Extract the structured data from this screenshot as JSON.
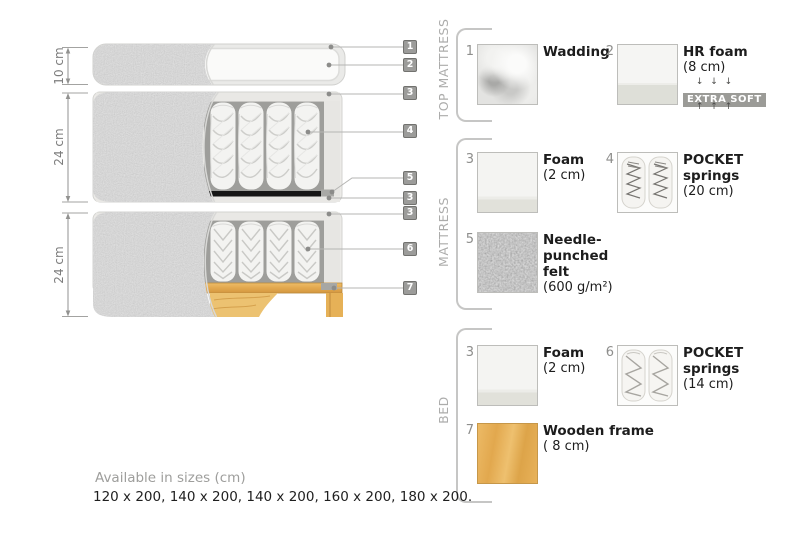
{
  "diagram": {
    "dim_labels": [
      "10 cm",
      "24 cm",
      "24 cm"
    ],
    "callouts": [
      "1",
      "2",
      "3",
      "4",
      "5",
      "3",
      "3",
      "6",
      "7"
    ]
  },
  "legend": {
    "groups": [
      {
        "title": "TOP MATTRESS"
      },
      {
        "title": "MATTRESS"
      },
      {
        "title": "BED"
      }
    ],
    "items": {
      "wadding": {
        "num": "1",
        "name": "Wadding"
      },
      "hr_foam": {
        "num": "2",
        "name": "HR foam",
        "detail": "(8 cm)",
        "arrows_down": "↓ ↓ ↓",
        "badge": "EXTRA SOFT",
        "arrows_up": "↑ ↑ ↑"
      },
      "foam_mattress": {
        "num": "3",
        "name": "Foam",
        "detail": "(2 cm)"
      },
      "pocket_20": {
        "num": "4",
        "line1": "POCKET",
        "line2": "springs",
        "detail": "(20 cm)"
      },
      "felt": {
        "num": "5",
        "line1": "Needle-",
        "line2": "punched",
        "line3": "felt",
        "detail": "(600 g/m²)"
      },
      "foam_bed": {
        "num": "3",
        "name": "Foam",
        "detail": "(2 cm)"
      },
      "pocket_14": {
        "num": "6",
        "line1": "POCKET",
        "line2": "springs",
        "detail": "(14 cm)"
      },
      "wooden_frame": {
        "num": "7",
        "name": "Wooden frame",
        "detail": "( 8  cm)"
      }
    }
  },
  "footer": {
    "line1": "Available in sizes (cm)",
    "line2": "120 x 200, 140 x 200, 140 x 200, 160 x 200, 180 x 200."
  },
  "colors": {
    "fabric_gray": "#a9a9a7",
    "wood": "#e2a84e",
    "badge_bg": "#9b9b97",
    "felt_gray": "#8a8a88",
    "tag_bg": "#9c9c9a"
  }
}
